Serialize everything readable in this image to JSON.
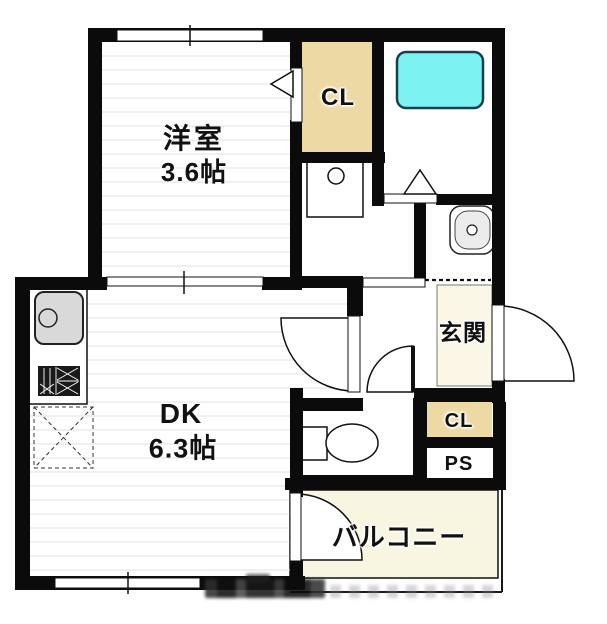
{
  "rooms": {
    "western_room": {
      "name": "洋室",
      "size": "3.6帖"
    },
    "dining_kitchen": {
      "name": "DK",
      "size": "6.3帖"
    },
    "closet_top": {
      "label": "CL"
    },
    "entrance": {
      "label": "玄関"
    },
    "closet_hall": {
      "label": "CL"
    },
    "pipe_space": {
      "label": "PS"
    },
    "balcony": {
      "label": "バルコニー"
    }
  },
  "fixtures": {
    "bathtub": "bathtub-icon",
    "kitchen_sink": "kitchen-sink-icon",
    "gas_stove": "gas-stove-icon",
    "refrigerator_space": "refrigerator-space-icon",
    "washing_machine_pan": "washing-machine-pan-icon",
    "washbasin": "washbasin-icon",
    "toilet": "toilet-icon"
  },
  "colors": {
    "wall": "#0b0b0b",
    "closet": "#ecd9a4",
    "entrance_floor": "#faf7e6",
    "balcony_floor": "#f8f6e0",
    "bathtub": "#7df2f2",
    "bathtub_border": "#16404e",
    "floor_line": "#e2e2e2",
    "fixture_gray": "#d9d9d9",
    "text": "#111111"
  }
}
